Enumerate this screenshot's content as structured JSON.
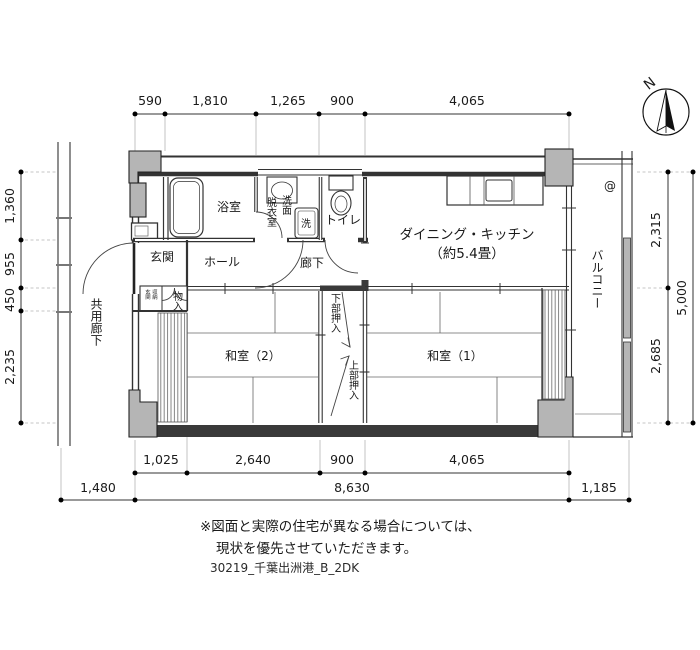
{
  "compass": {
    "label": "N"
  },
  "dimensions": {
    "top": [
      "590",
      "1,810",
      "1,265",
      "900",
      "4,065"
    ],
    "left": [
      "1,360",
      "955",
      "450",
      "2,235"
    ],
    "right": [
      "2,315",
      "2,685"
    ],
    "right_total": "5,000",
    "bottom_inner": [
      "1,025",
      "2,640",
      "900",
      "4,065"
    ],
    "bottom_outer": [
      "1,480",
      "8,630",
      "1,185"
    ]
  },
  "rooms": {
    "bathroom": "浴室",
    "dressing_room": "脱衣室",
    "washbasin": "洗面",
    "washer": "洗",
    "toilet": "トイレ",
    "dining_kitchen": "ダイニング・キッチン",
    "dining_kitchen_size": "（約5.4畳）",
    "entrance": "玄関",
    "hall": "ホール",
    "corridor": "廊下",
    "shared_corridor": "共用廊下",
    "balcony": "バルコニー",
    "japanese_room_2": "和室（2）",
    "japanese_room_1": "和室（1）",
    "closet_lower": "下部押入",
    "closet_upper": "上部押入",
    "storage": "物入",
    "entrance_storage_col1": "玄関",
    "entrance_storage_col2": "収納"
  },
  "icons": {
    "balcony_drain": "@"
  },
  "notes": {
    "line1": "※図面と実際の住宅が異なる場合については、",
    "line2": "現状を優先させていただきます。",
    "file_label": "30219_千葉出洲港_B_2DK"
  }
}
